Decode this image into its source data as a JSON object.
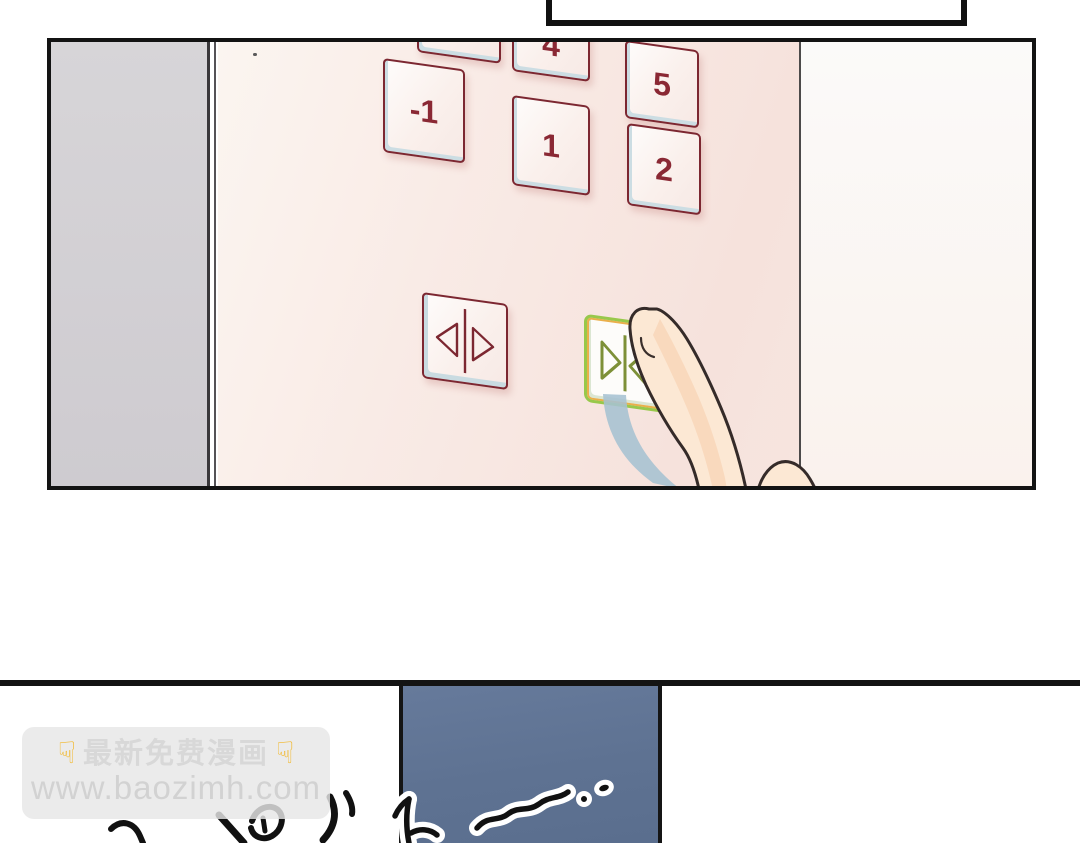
{
  "watermark": {
    "pointer_glyph": "☟",
    "title": "最新免费漫画",
    "url": "www.baozimh.com"
  },
  "elevator_panel": {
    "floor_buttons": [
      {
        "id": "floor-button-partial",
        "label": ""
      },
      {
        "id": "floor-button-4",
        "label": "4"
      },
      {
        "id": "floor-button-5",
        "label": "5"
      },
      {
        "id": "floor-button-minus-1",
        "label": "-1"
      },
      {
        "id": "floor-button-1",
        "label": "1"
      },
      {
        "id": "floor-button-2",
        "label": "2"
      }
    ],
    "door_open_button": {
      "icon": "door-open-icon"
    },
    "door_close_button": {
      "icon": "door-close-icon",
      "state": "pressed"
    }
  },
  "colors": {
    "button_red": "#7c2731",
    "digit_red": "#8a2834",
    "pressed_green": "#98c84b",
    "pressed_orange": "#eaaf4b",
    "bevel_blue": "#ccdde3",
    "wall_pink": "#f8ebe5",
    "elevator_door_gray": "#d3d1d4",
    "lower_panel_blue": "#5e7292",
    "finger_shadow_blue": "#a6c1d1"
  }
}
